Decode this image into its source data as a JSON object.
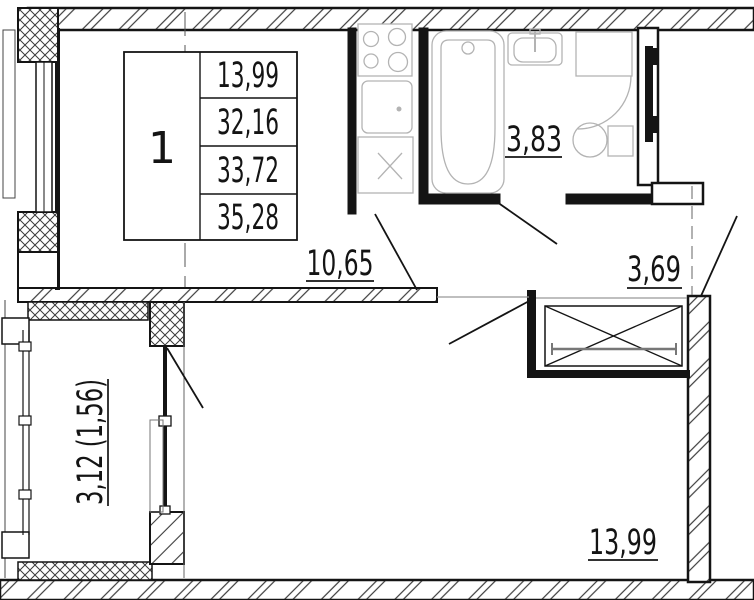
{
  "plan": {
    "type": "apartment-floor-plan",
    "unit_table": {
      "rooms_count": "1",
      "values": [
        "13,99",
        "32,16",
        "33,72",
        "35,28"
      ]
    },
    "labels": {
      "kitchen_area": "10,65",
      "bathroom_area": "3,83",
      "hall_area": "3,69",
      "room_area": "13,99",
      "balcony_area": "3,12 (1,56)"
    },
    "colors": {
      "line": "#141414",
      "hatch": "#3c3c3c",
      "fixture": "#b3b3b3",
      "background": "#ffffff"
    }
  }
}
